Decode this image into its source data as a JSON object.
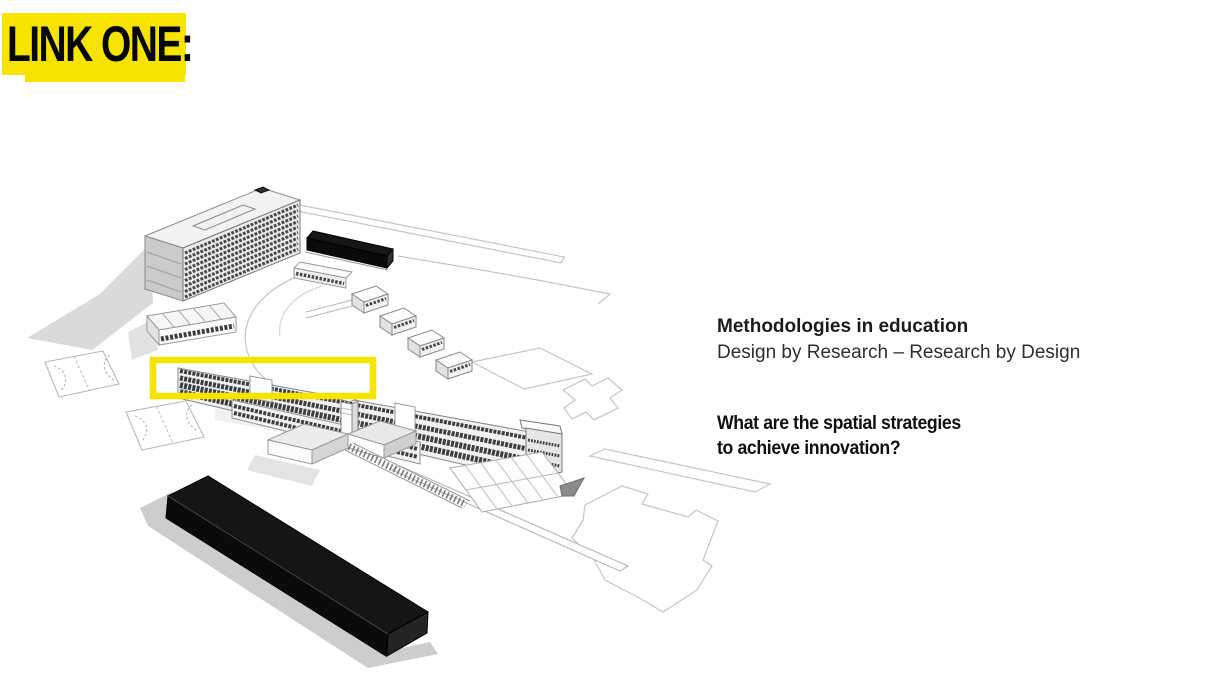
{
  "slide": {
    "background_color": "#FFFFFF",
    "link_label": "LINK ONE:",
    "link_highlight_color": "#F6E400"
  },
  "text_block": {
    "title": "Methodologies in education",
    "subtitle": "Design by Research – Research by Design",
    "question_line1": "What are the spatial strategies",
    "question_line2": "to achieve innovation?"
  },
  "figure": {
    "type": "architectural-axonometric-drawing",
    "caption": "Campus massing drawing with a yellow rectangle highlighting one linear wing",
    "colors": {
      "building_black": "#0b0b0b",
      "facade_gray": "#ececec",
      "window_band": "#434343",
      "outline_gray": "#c5c5c5",
      "shadow_gray": "#d8d8d8",
      "highlight_yellow": "#F6E400"
    },
    "elements": [
      "tower-slab-building",
      "rooftop-black-bar",
      "terraced-studio-blocks",
      "skylight-roof-building",
      "classroom-wing",
      "lower-wing",
      "chimney-tower",
      "pitched-roof-workshops",
      "pergola-structure",
      "outdoor-stairs",
      "black-bar-building",
      "sports-courts",
      "site-plan-outlines",
      "highlight-rectangle"
    ]
  }
}
